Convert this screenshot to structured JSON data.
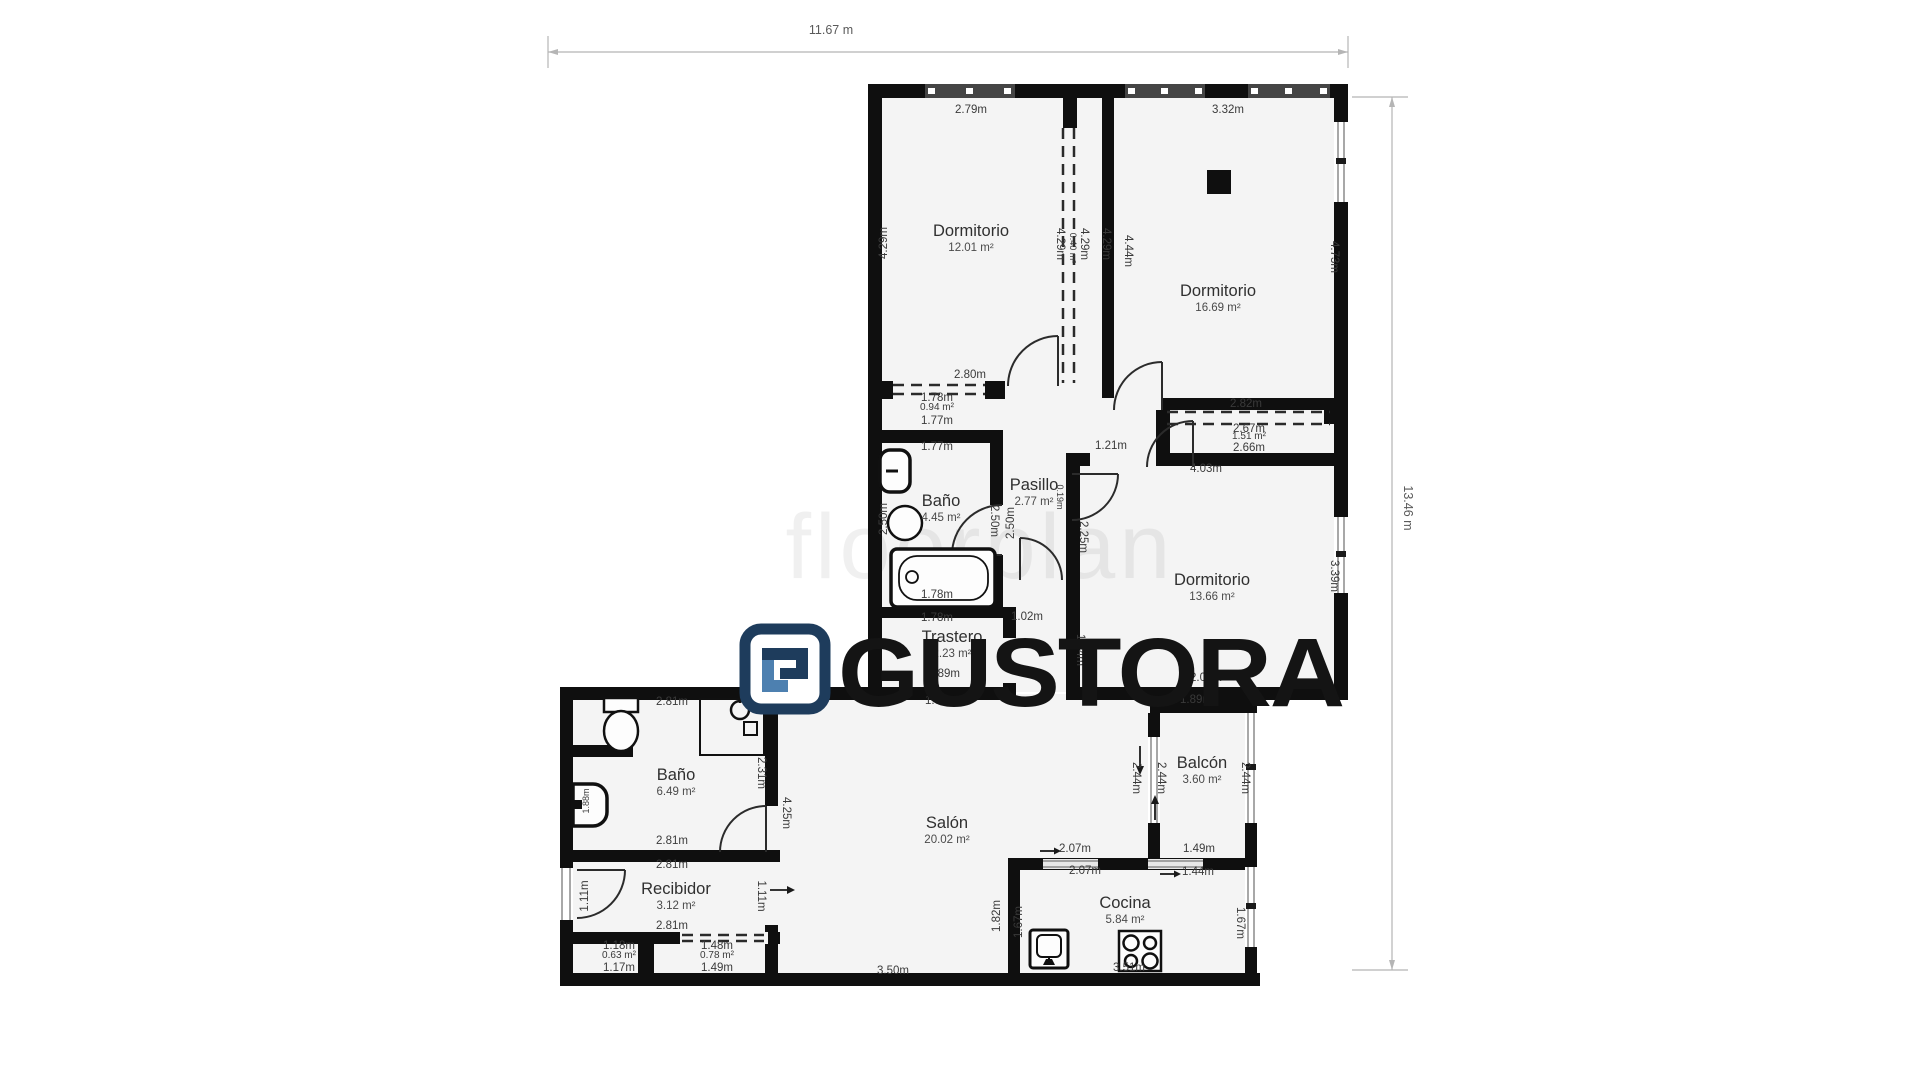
{
  "meta": {
    "title": "Floor plan",
    "background": "#ffffff"
  },
  "colors": {
    "wall": "#0f0f0f",
    "room_fill": "#f4f4f4",
    "dim_text": "#3a3a3a",
    "room_name_text": "#303030",
    "dim_line": "#b5b5b5",
    "logo_navy": "#1e3c5c",
    "logo_light_blue": "#4d80b0",
    "logo_text_color": "#141414"
  },
  "overall_dimensions": {
    "width_label": "11.67 m",
    "height_label": "13.46 m"
  },
  "watermark_text": "floorplan",
  "logo": {
    "text": "GUSTORA",
    "icon": "gustora-maze-monogram"
  },
  "icons": {
    "column": "filled-square",
    "toilet": "tank-and-bowl-outline",
    "washbasin": "oval-outline",
    "bathtub": "rounded-rect-with-drain",
    "shower": "shower-head-circle-and-mixer-square",
    "wall-sink": "half-rounded-rect",
    "kitchen-sink": "square-basin-with-faucet",
    "stove": "four-burner-circles",
    "direction-arrow": "→"
  },
  "rooms": [
    {
      "name": "Dormitorio",
      "area": "12.01 m²",
      "x": 971,
      "y": 236
    },
    {
      "name": "Dormitorio",
      "area": "16.69 m²",
      "x": 1218,
      "y": 296
    },
    {
      "name": "Baño",
      "area": "4.45 m²",
      "x": 941,
      "y": 506
    },
    {
      "name": "Pasillo",
      "area": "2.77 m²",
      "x": 1034,
      "y": 490
    },
    {
      "name": "Dormitorio",
      "area": "13.66 m²",
      "x": 1212,
      "y": 585
    },
    {
      "name": "Trastero",
      "area": "2.23 m²",
      "x": 952,
      "y": 642
    },
    {
      "name": "Baño",
      "area": "6.49 m²",
      "x": 676,
      "y": 780
    },
    {
      "name": "Recibidor",
      "area": "3.12 m²",
      "x": 676,
      "y": 894
    },
    {
      "name": "Salón",
      "area": "20.02 m²",
      "x": 947,
      "y": 828
    },
    {
      "name": "Balcón",
      "area": "3.60 m²",
      "x": 1202,
      "y": 768
    },
    {
      "name": "Cocina",
      "area": "5.84 m²",
      "x": 1125,
      "y": 908
    }
  ],
  "dim_labels": [
    {
      "t": "2.79m",
      "x": 971,
      "y": 113
    },
    {
      "t": "3.32m",
      "x": 1228,
      "y": 113
    },
    {
      "t": "4.29m",
      "x": 887,
      "y": 243,
      "r": -90
    },
    {
      "t": "4.29m",
      "x": 1057,
      "y": 244,
      "r": 90
    },
    {
      "t": "0.40 m²",
      "x": 1070,
      "y": 248,
      "r": 90,
      "s": 9
    },
    {
      "t": "4.29m",
      "x": 1081,
      "y": 244,
      "r": 90
    },
    {
      "t": "4.29m",
      "x": 1103,
      "y": 244,
      "r": 90
    },
    {
      "t": "4.44m",
      "x": 1125,
      "y": 251,
      "r": 90
    },
    {
      "t": "4.73m",
      "x": 1331,
      "y": 257,
      "r": 90
    },
    {
      "t": "2.80m",
      "x": 970,
      "y": 378
    },
    {
      "t": "1.78m",
      "x": 937,
      "y": 401
    },
    {
      "t": "0.94 m²",
      "x": 937,
      "y": 410,
      "s": 10
    },
    {
      "t": "1.77m",
      "x": 937,
      "y": 424
    },
    {
      "t": "1.77m",
      "x": 937,
      "y": 450
    },
    {
      "t": "2.50m",
      "x": 887,
      "y": 519,
      "r": -90
    },
    {
      "t": "2.50m",
      "x": 991,
      "y": 521,
      "r": 90
    },
    {
      "t": "2.50m",
      "x": 1014,
      "y": 523,
      "r": -90
    },
    {
      "t": "0.19m",
      "x": 1057,
      "y": 497,
      "r": 90,
      "s": 9
    },
    {
      "t": "1.21m",
      "x": 1111,
      "y": 449
    },
    {
      "t": "2.25m",
      "x": 1080,
      "y": 537,
      "r": 90
    },
    {
      "t": "1.78m",
      "x": 937,
      "y": 598
    },
    {
      "t": "1.78m",
      "x": 937,
      "y": 621
    },
    {
      "t": "1.02m",
      "x": 1027,
      "y": 620
    },
    {
      "t": "1.89m",
      "x": 944,
      "y": 677
    },
    {
      "t": "1.89m",
      "x": 941,
      "y": 704
    },
    {
      "t": "2.82m",
      "x": 1246,
      "y": 407
    },
    {
      "t": "2.67m",
      "x": 1249,
      "y": 432
    },
    {
      "t": "1.51 m²",
      "x": 1249,
      "y": 439,
      "s": 10
    },
    {
      "t": "2.66m",
      "x": 1249,
      "y": 451
    },
    {
      "t": "4.03m",
      "x": 1206,
      "y": 472
    },
    {
      "t": "3.39m",
      "x": 1331,
      "y": 576,
      "r": 90
    },
    {
      "t": "1.14m",
      "x": 1077,
      "y": 650,
      "r": 90
    },
    {
      "t": "2.03m",
      "x": 1206,
      "y": 681
    },
    {
      "t": "1.89m",
      "x": 1196,
      "y": 703
    },
    {
      "t": "2.81m",
      "x": 672,
      "y": 705
    },
    {
      "t": "2.31m",
      "x": 758,
      "y": 773,
      "r": 90
    },
    {
      "t": "1.88m",
      "x": 589,
      "y": 801,
      "r": -90,
      "s": 9
    },
    {
      "t": "2.81m",
      "x": 672,
      "y": 844
    },
    {
      "t": "2.81m",
      "x": 672,
      "y": 868
    },
    {
      "t": "2.81m",
      "x": 672,
      "y": 929
    },
    {
      "t": "1.11m",
      "x": 588,
      "y": 896,
      "r": -90
    },
    {
      "t": "1.11m",
      "x": 758,
      "y": 896,
      "r": 90
    },
    {
      "t": "4.25m",
      "x": 783,
      "y": 813,
      "r": 90
    },
    {
      "t": "1.18m",
      "x": 619,
      "y": 949
    },
    {
      "t": "0.63 m²",
      "x": 619,
      "y": 958,
      "s": 10
    },
    {
      "t": "1.17m",
      "x": 619,
      "y": 971
    },
    {
      "t": "1.48m",
      "x": 717,
      "y": 949
    },
    {
      "t": "0.78 m²",
      "x": 717,
      "y": 958,
      "s": 10
    },
    {
      "t": "1.49m",
      "x": 717,
      "y": 971
    },
    {
      "t": "3.50m",
      "x": 893,
      "y": 974
    },
    {
      "t": "1.82m",
      "x": 1000,
      "y": 916,
      "r": -90
    },
    {
      "t": "2.44m",
      "x": 1133,
      "y": 778,
      "r": 90
    },
    {
      "t": "2.44m",
      "x": 1158,
      "y": 778,
      "r": 90
    },
    {
      "t": "2.44m",
      "x": 1242,
      "y": 778,
      "r": 90
    },
    {
      "t": "2.07m",
      "x": 1075,
      "y": 852
    },
    {
      "t": "1.49m",
      "x": 1199,
      "y": 852
    },
    {
      "t": "2.07m",
      "x": 1085,
      "y": 874
    },
    {
      "t": "1.44m",
      "x": 1198,
      "y": 875
    },
    {
      "t": "1.67m",
      "x": 1022,
      "y": 922,
      "r": -90
    },
    {
      "t": "1.67m",
      "x": 1237,
      "y": 923,
      "r": 90
    },
    {
      "t": "3.51m",
      "x": 1129,
      "y": 971
    }
  ]
}
